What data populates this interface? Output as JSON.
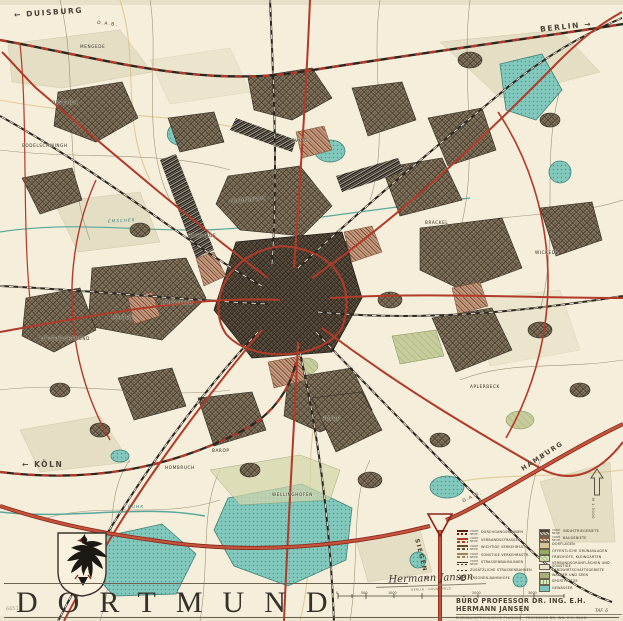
{
  "map": {
    "title": "DORTMUND",
    "plate_label": "TAF. 6",
    "inventory_number": "6651",
    "directions": {
      "duisburg_arrow": "←",
      "duisburg": "DUISBURG",
      "berlin": "BERLIN",
      "berlin_arrow": "→",
      "koeln_arrow": "←",
      "koeln": "KÖLN",
      "hamburg": "HAMBURG",
      "siegen": "SIEGEN",
      "siegen_arrow": "↓"
    },
    "route_label": "D.A.B.",
    "rivers": {
      "emscher": "EMSCHER",
      "ruhr": "RUHR"
    },
    "districts": [
      "MENGEDE",
      "OESTRICH",
      "BODELSCHWINGH",
      "HUCKARDE",
      "EVING",
      "FREDENBAUM",
      "BRACKEL",
      "WICKEDE",
      "DORSTFELD",
      "MARTEN",
      "LÜTGENDORTMUND",
      "BAROP",
      "HOMBRUCH",
      "HÖRDE",
      "WELLINGHOFEN",
      "APLERBECK"
    ],
    "legend": {
      "prefix_vorh": "VORH.",
      "prefix_neue": "NEUE",
      "col1": [
        {
          "label": "DURCHGANGSBAHNEN"
        },
        {
          "label": "VERBANDSSTRASSEN"
        },
        {
          "label": "WICHTIGE VERKEHRSSTR."
        },
        {
          "label": "SONSTIGE VERKEHRSSTR."
        },
        {
          "label": "STRASSENBAHNLINIEN"
        },
        {
          "label": "ZUSÄTZLICHE STRASSENBAHNEN"
        },
        {
          "label": "PERSONEN-BAHNHÖFE"
        }
      ],
      "col2": [
        {
          "label": "INDUSTRIEGEBIETE"
        },
        {
          "label": "BAUGEBIETE"
        },
        {
          "label": "DORFLAGEN"
        },
        {
          "label": "ÖFFENTLICHE GRÜNANLAGEN"
        },
        {
          "label": "FRIEDHÖFE, KLEINGÄRTEN"
        },
        {
          "label": "VERBANDSGRÜNFLÄCHEN UND SONSTIGE LANDWIRTSCHAFTSGEBIETE"
        },
        {
          "label": "WÄLDER UND SEEN"
        },
        {
          "label": "SPORTPLÄTZE"
        },
        {
          "label": "GEWÄSSER"
        }
      ]
    },
    "scale_bar": {
      "ticks": [
        "0",
        "500",
        "1000",
        "2000",
        "3000"
      ]
    },
    "north_arrow_label": "M 1:5000",
    "credit": {
      "line1": "BÜRO PROFESSOR DR. ING. E.H. HERMANN JANSEN",
      "line2": "EISENBAHNTECHNISCHE PLANUNG · PROFESSOR DR. ING. E.H. BLUM"
    },
    "signature": {
      "name": "Hermann Jansen",
      "caption": "BERLIN · GRUNEWALD"
    },
    "colors": {
      "paper": "#f4eeda",
      "road_red": "#b23a28",
      "rail_black": "#2b2520",
      "water_teal": "#7cc7bd",
      "urban_brown": "#8d7d63",
      "accent_dark": "#3c342a"
    }
  }
}
